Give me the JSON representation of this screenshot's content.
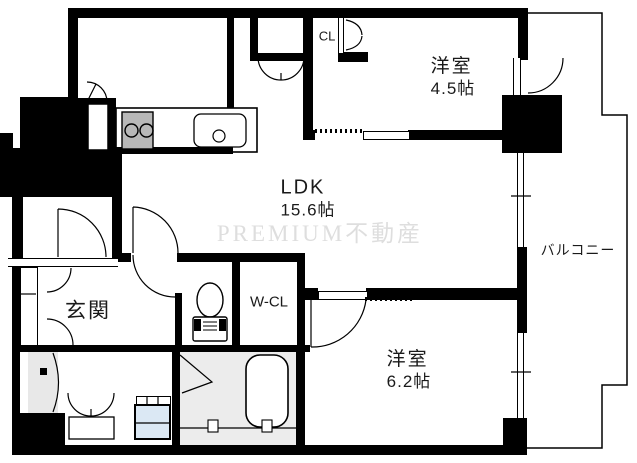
{
  "floorplan": {
    "rooms": {
      "ldk": {
        "name": "LDK",
        "size": "15.6帖"
      },
      "bedroom1": {
        "name": "洋室",
        "size": "4.5帖"
      },
      "bedroom2": {
        "name": "洋室",
        "size": "6.2帖"
      },
      "entrance": {
        "name": "玄関"
      },
      "walk_in_closet": {
        "name": "W-CL"
      },
      "closet": {
        "name": "CL"
      },
      "balcony": {
        "name": "バルコニー"
      }
    },
    "watermark": "PREMIUM不動産",
    "fixtures": [
      "kitchen-counter",
      "gas-stove",
      "kitchen-sink",
      "refrigerator-space",
      "toilet",
      "bathtub",
      "washing-machine-pan",
      "washbasin",
      "shoe-cabinet",
      "sliding-doors",
      "hinged-doors"
    ],
    "colors": {
      "wall": "#000000",
      "stove": "#b8b8b8",
      "washer_pan": "#dbe8f4",
      "bathroom_floor": "#ececec",
      "washroom_mat": "#e8e8e8",
      "watermark": "#dedede"
    }
  }
}
